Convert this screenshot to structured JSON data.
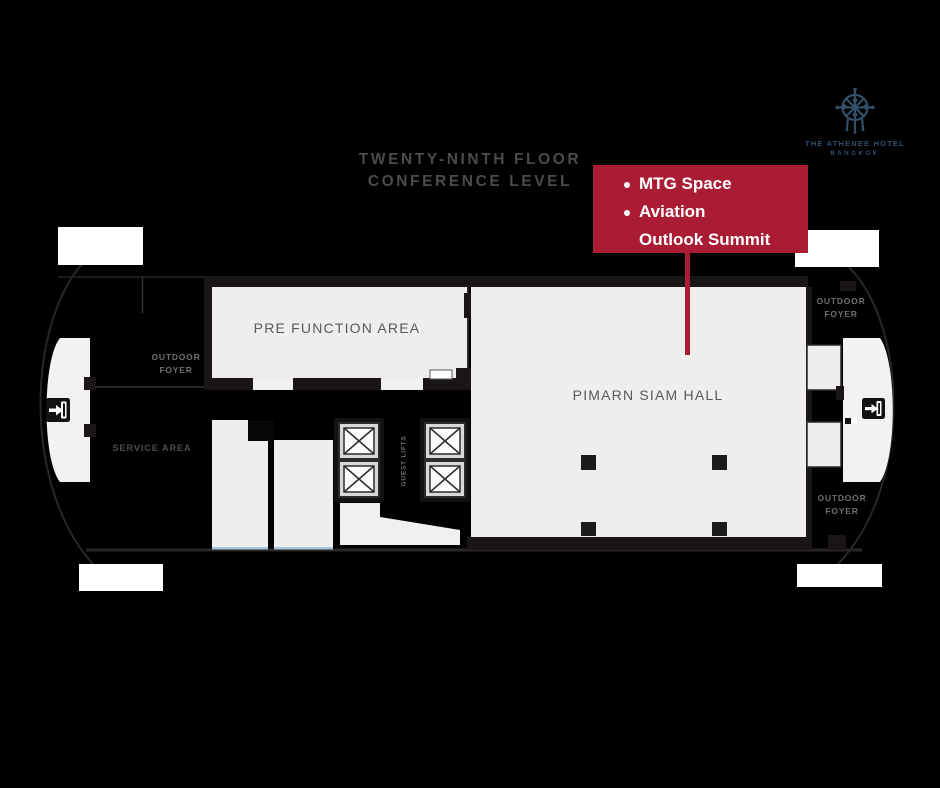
{
  "title": {
    "line1": "TWENTY-NINTH FLOOR",
    "line2": "CONFERENCE LEVEL"
  },
  "logo": {
    "name": "THE ATHENEE HOTEL",
    "city": "BANGKOK"
  },
  "legend": {
    "items": [
      {
        "text": "MTG Space"
      },
      {
        "text": "Aviation"
      },
      {
        "text": "Outlook Summit"
      }
    ]
  },
  "rooms": {
    "pre_function": "PRE FUNCTION AREA",
    "hall": "PIMARN SIAM HALL",
    "service": "SERVICE AREA",
    "guest_lifts": "GUEST LIFTS",
    "outdoor_foyer": {
      "line1": "OUTDOOR",
      "line2": "FOYER"
    }
  },
  "colors": {
    "accent_red": "#aa1c33",
    "room_fill": "#efeeec",
    "wall_black": "#1a1617",
    "logo_navy": "#33506b",
    "label_gray": "#58595b",
    "glass_blue": "#a9c3de"
  }
}
